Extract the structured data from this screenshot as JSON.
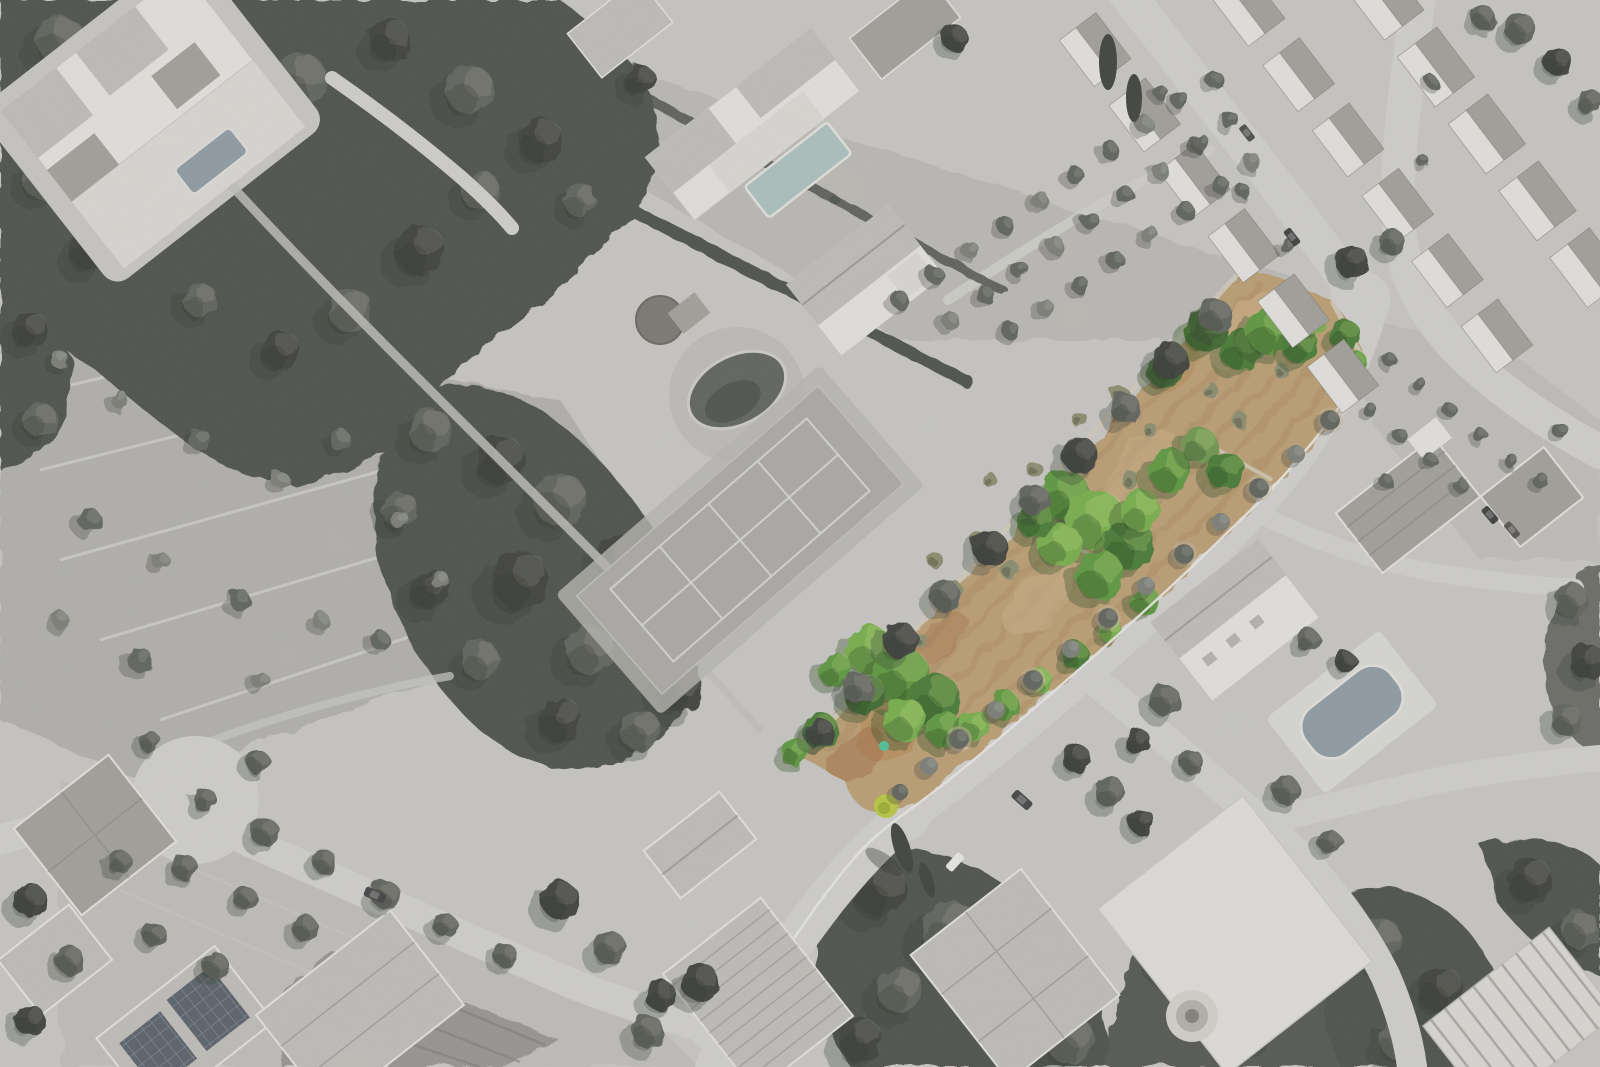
{
  "image": {
    "type": "aerial drone photograph",
    "style": "black-and-white photograph with one land parcel highlighted in colour",
    "description": "Grayscale aerial view of a Mediterranean residential neighbourhood. A long diagonal building plot is highlighted in colour: ochre dry grass, scattered olive trees and bright green shrubs, bordered by a stone wall on one side and a street with young street trees on the other. Surroundings include villas with swimming pools, a tennis court, a pond, pine woodland, terraced scrubland, orchards, farm plots, a row-house estate and parked cars.",
    "highlighted_plot": {
      "label": "highlighted building plot",
      "orientation": "long strip running from upper right to lower left",
      "ground_cover": "dry ochre grass with rust-coloured patches",
      "vegetation": [
        "olive trees",
        "bright green shrub clusters",
        "dense shrub mass at the lower half"
      ],
      "accent_features": [
        "lime-green bush at the southern tip",
        "small teal shrub near the tip"
      ],
      "border_northwest": "stone wall with a row of orchard trees",
      "border_southeast": "kerbed street with evenly spaced street trees"
    },
    "surroundings": [
      "pine forest and large villa with pool (top left)",
      "villa with swimming pool (top centre)",
      "stone hut, pond and tennis court (centre)",
      "terraced scrubland with retaining walls (left)",
      "orchards, crop field and houses with solar panels (bottom left)",
      "row-house estate along two streets (top right)",
      "villa with pool and parking (centre right)",
      "courtyard building with circular fountain (bottom centre)",
      "ribbed warehouse roof (bottom right corner)",
      "circular turning area (bottom left road)"
    ],
    "vehicles": [
      "dark car on lower left road",
      "dark car near plot tip junction",
      "white van on driveway",
      "two parked cars at centre-right parking",
      "cars on estate streets"
    ]
  },
  "colors": {
    "ground": "#cfcecb",
    "scrub": "#b7b6b2",
    "orchard": "#c7c5c1",
    "garden": "#c2c0bb",
    "field_dark": "#9b9994",
    "road": "#d9d8d5",
    "road_light": "#e4e3e0",
    "curb": "#f2f1ee",
    "forest": "#4c504a",
    "forest_dark": "#3b3e38",
    "tree_mid": "#5f635b",
    "tree_light": "#7c8077",
    "tree_pale": "#94978e",
    "shadow": "#31342e",
    "bldg": "#eeece8",
    "bldg_warm": "#e3e1dc",
    "roof_light": "#c6c4bf",
    "roof_mid": "#a6a49e",
    "roof_dark": "#868480",
    "panel": "#596069",
    "court": "#b1afab",
    "line_light": "#dddcd8",
    "wall": "#d8d1c1",
    "pond": "#5f635c",
    "pool_teal": "#b2c8c5",
    "pool_gray": "#929fa7",
    "plot_tan": "#c2a273",
    "plot_tan_light": "#d1b286",
    "plot_orange": "#bb8950",
    "plot_rust": "#a56a40",
    "green_bright": "#78b44a",
    "green_mid": "#5b9c3a",
    "green_deep": "#457c30",
    "green_dark": "#3a682b",
    "olive": "#8e9070",
    "accent_yellow": "#c0cf3f",
    "accent_teal": "#4fc89b"
  }
}
